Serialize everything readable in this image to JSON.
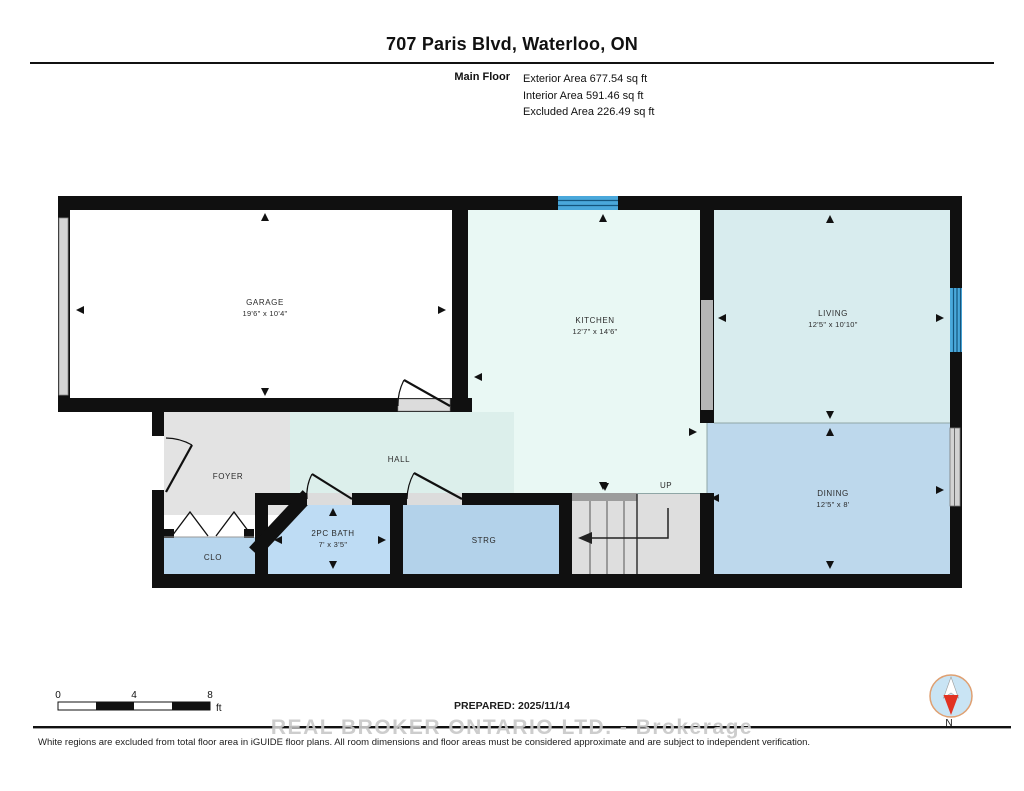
{
  "header": {
    "title": "707 Paris Blvd, Waterloo, ON",
    "floor_label": "Main Floor",
    "stats": {
      "exterior": "Exterior Area 677.54 sq ft",
      "interior": "Interior Area 591.46 sq ft",
      "excluded": "Excluded Area 226.49 sq ft"
    }
  },
  "rooms": {
    "garage": {
      "name": "GARAGE",
      "dims": "19'6\" x 10'4\""
    },
    "kitchen": {
      "name": "KITCHEN",
      "dims": "12'7\" x 14'6\""
    },
    "living": {
      "name": "LIVING",
      "dims": "12'5\" x 10'10\""
    },
    "dining": {
      "name": "DINING",
      "dims": "12'5\" x 8'"
    },
    "hall": {
      "name": "HALL"
    },
    "foyer": {
      "name": "FOYER"
    },
    "bath": {
      "name": "2PC BATH",
      "dims": "7' x 3'5\""
    },
    "storage": {
      "name": "STRG"
    },
    "closet": {
      "name": "CLO"
    },
    "stairs": {
      "label": "UP"
    }
  },
  "scale_bar": {
    "tick0": "0",
    "tick1": "4",
    "tick2": "8",
    "unit": "ft"
  },
  "footer": {
    "prepared": "PREPARED: 2025/11/14",
    "watermark": "REAL BROKER ONTARIO LTD. - Brokerage",
    "disclaimer": "White regions are excluded from total floor area in iGUIDE floor plans. All room dimensions and floor areas must be considered approximate and are subject to independent verification.",
    "compass_label": "N"
  },
  "colors": {
    "wall": "#101010",
    "window_blue": "#4aa8db",
    "window_gray": "#d2d2d2",
    "garage_fill": "#ffffff",
    "kitchen_fill": "#e9f8f4",
    "hall_fill": "#dcefeb",
    "living_fill": "#d8ecee",
    "dining_fill": "#bdd8ec",
    "bath_fill": "#bedcf4",
    "storage_fill": "#b3d2ea",
    "closet_fill": "#b7d6ee",
    "foyer_fill": "#e3e3e3",
    "stairs_fill": "#dedede"
  }
}
